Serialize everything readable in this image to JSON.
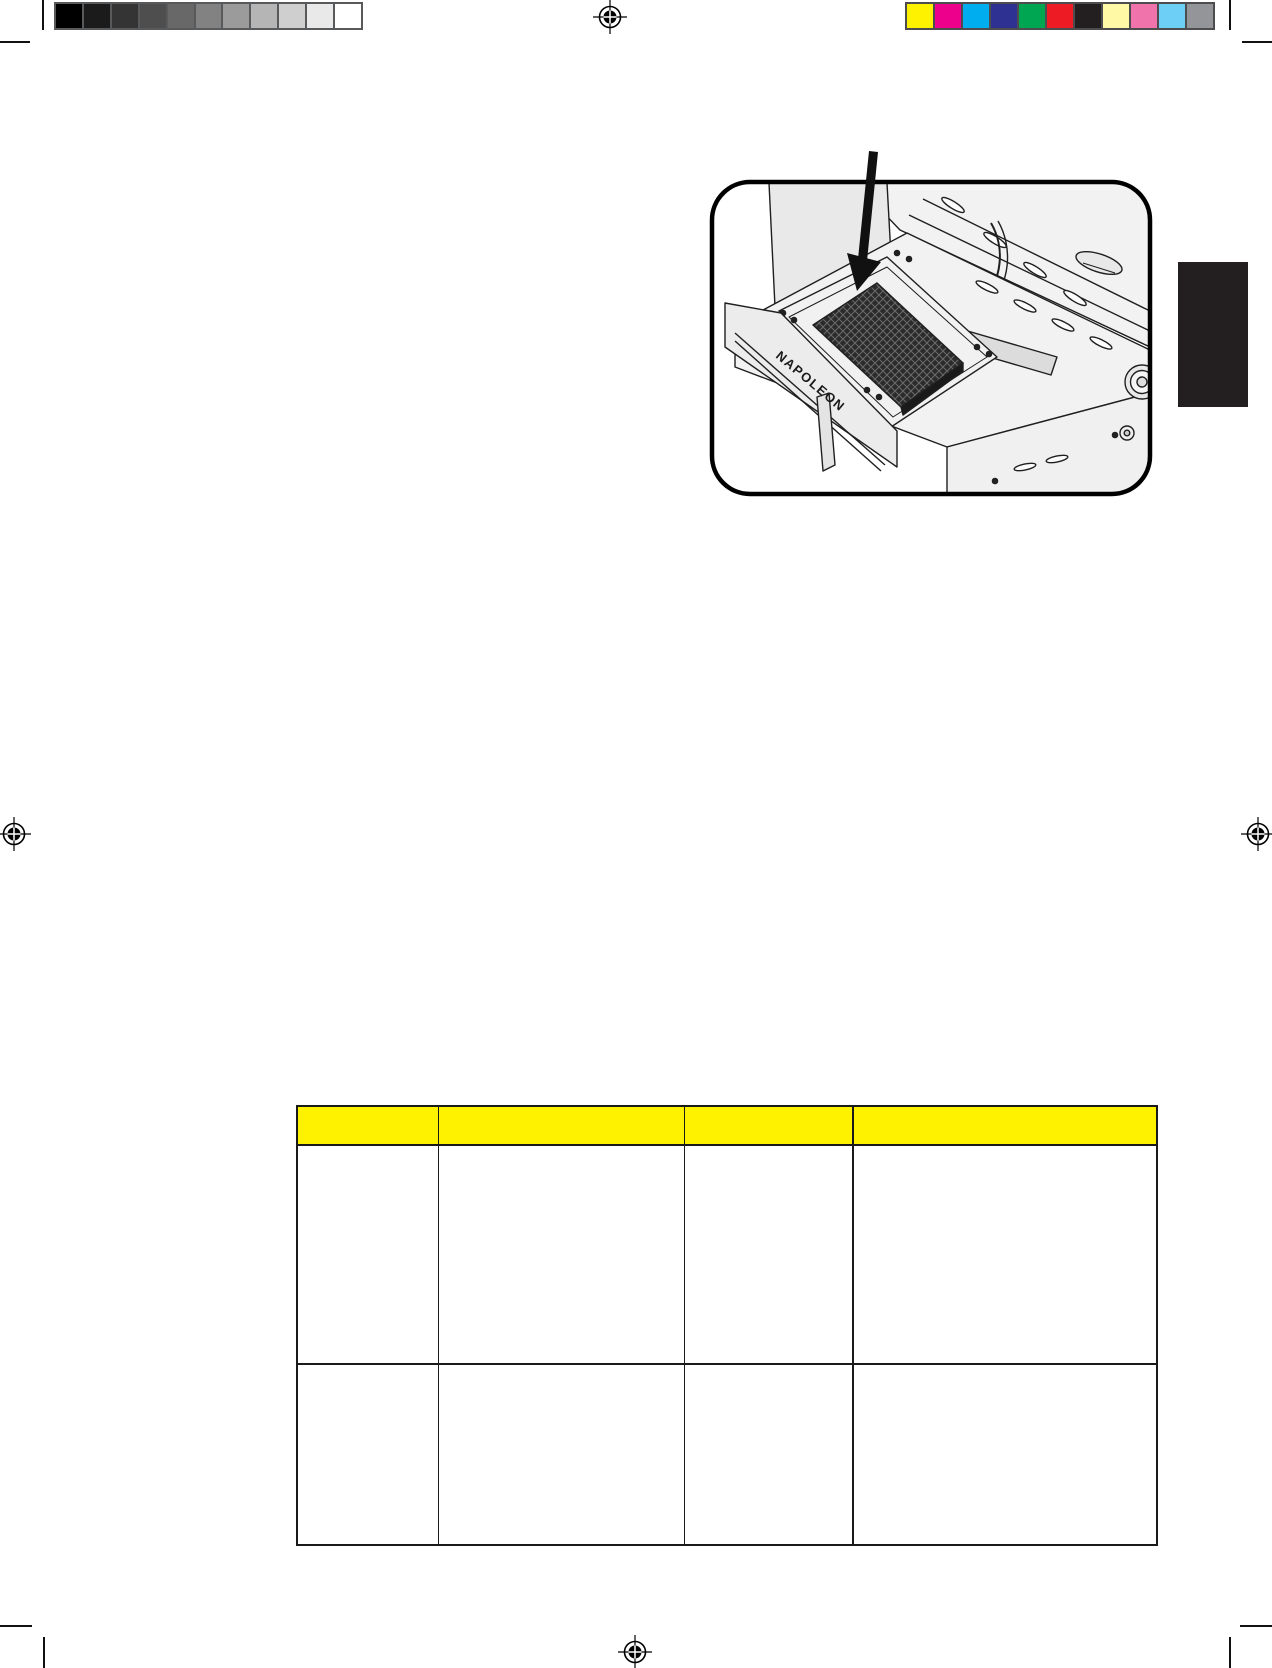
{
  "page": {
    "width": 1272,
    "height": 1668,
    "background": "#ffffff"
  },
  "print_marks": {
    "grayscale_bar": {
      "border_color": "#58595b",
      "swatches": [
        "#000000",
        "#1b1b1b",
        "#343434",
        "#4e4e4e",
        "#686868",
        "#828282",
        "#9b9b9b",
        "#b5b5b5",
        "#cfcfcf",
        "#e9e9e9",
        "#ffffff"
      ]
    },
    "color_bar": {
      "border_color": "#4d4d4f",
      "swatches": [
        "#fff200",
        "#ec008c",
        "#00aeef",
        "#2e3192",
        "#00a651",
        "#ed1c24",
        "#231f20",
        "#fff9a6",
        "#f173ac",
        "#6dcff6",
        "#939598"
      ]
    },
    "registration_marks": [
      {
        "cx": 610,
        "cy": 17
      },
      {
        "cx": 14,
        "cy": 834
      },
      {
        "cx": 1258,
        "cy": 834
      },
      {
        "cx": 635,
        "cy": 1652
      }
    ],
    "crop_marks": [
      {
        "x": 0,
        "y": 41,
        "w": 30,
        "h": 2
      },
      {
        "x": 42,
        "y": 0,
        "w": 2,
        "h": 30
      },
      {
        "x": 1229,
        "y": 0,
        "w": 2,
        "h": 30
      },
      {
        "x": 1242,
        "y": 41,
        "w": 30,
        "h": 2
      },
      {
        "x": 0,
        "y": 1625,
        "w": 32,
        "h": 2
      },
      {
        "x": 43,
        "y": 1637,
        "w": 2,
        "h": 31
      },
      {
        "x": 1229,
        "y": 1637,
        "w": 2,
        "h": 31
      },
      {
        "x": 1240,
        "y": 1625,
        "w": 32,
        "h": 2
      }
    ]
  },
  "illustration": {
    "brand_text": "NAPOLEON",
    "frame_border_color": "#000000",
    "line_color": "#1f1f1f",
    "body_fill": "#f2f2f2",
    "grate_fill": "#2b2b2b"
  },
  "side_tab": {
    "x": 1178,
    "y": 262,
    "w": 70,
    "h": 145,
    "color": "#231f20"
  },
  "table": {
    "geometry": {
      "left": 296,
      "top": 1105,
      "width": 862
    },
    "header_bg": "#fff200",
    "border_color": "#1a1a1a",
    "col_widths_px": [
      141,
      246,
      169,
      306
    ],
    "row_heights_px": [
      39,
      219,
      179
    ],
    "columns": [
      "",
      "",
      "",
      ""
    ],
    "rows": [
      [
        "",
        "",
        "",
        ""
      ],
      [
        "",
        "",
        "",
        ""
      ]
    ]
  }
}
